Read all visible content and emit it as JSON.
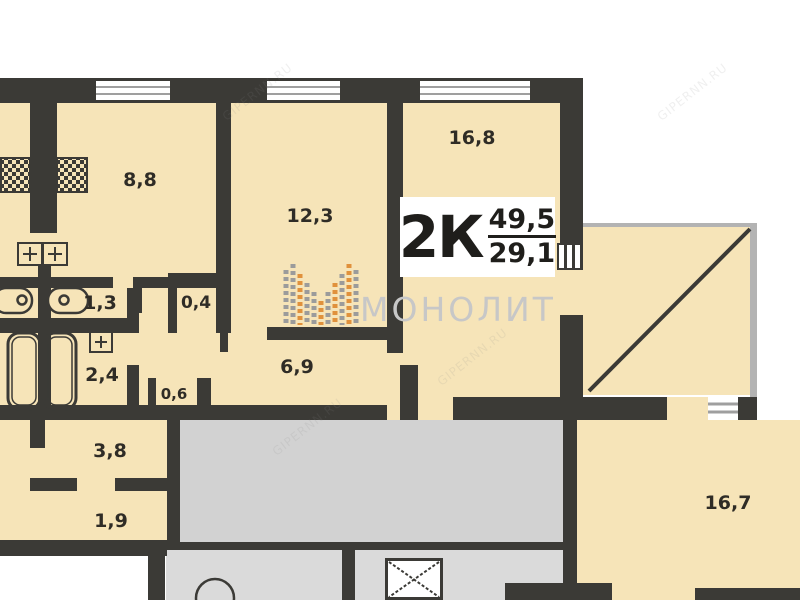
{
  "unit_badge": {
    "type": "2К",
    "total": "49,5",
    "living": "29,1"
  },
  "watermark": {
    "brand": "МОНОЛИТ",
    "site": "GIPERNN.RU"
  },
  "rooms": [
    {
      "name": "kitchen",
      "area": "8,8"
    },
    {
      "name": "room-12",
      "area": "12,3"
    },
    {
      "name": "room-16",
      "area": "16,8"
    },
    {
      "name": "wc",
      "area": "1,3"
    },
    {
      "name": "closet-04",
      "area": "0,4"
    },
    {
      "name": "bathroom",
      "area": "2,4"
    },
    {
      "name": "niche-06",
      "area": "0,6"
    },
    {
      "name": "hallway",
      "area": "6,9"
    },
    {
      "name": "neighbor-hallway",
      "area": "3,8"
    },
    {
      "name": "neighbor-closet",
      "area": "1,9"
    },
    {
      "name": "neighbor-room",
      "area": "16,7"
    }
  ],
  "colors": {
    "wall": "#3b3a36",
    "room_fill": "#f6e4b8",
    "common_area": "#d2d2d2",
    "logo_orange": "#e0913c",
    "logo_gray": "#9b9b9b"
  }
}
